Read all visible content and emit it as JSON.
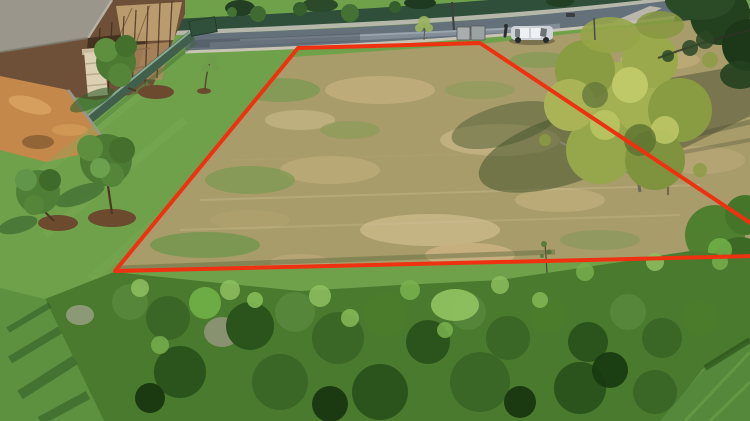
{
  "image": {
    "kind": "aerial-drone-photo",
    "subject": "vacant grass plot marked with a red boundary outline beside a street",
    "width": 750,
    "height": 421
  },
  "boundary": {
    "name": "plot-boundary",
    "color": "#ee3211",
    "stroke_width": "4",
    "path": "M 758 256 L 115 271 L 298 48 L 480 43 L 758 228",
    "corner_points": "298,48 480,43 750,223 750,258 115,271"
  },
  "palette": {
    "lawn_green": "#6fa14b",
    "lawn_dark": "#5d9140",
    "field_dry_grass": "#a89c6a",
    "road_asphalt": "#64707a",
    "curb_concrete": "#c8c4b4",
    "sidewalk_grey": "#b5b7ab",
    "fence_hedge_dark": "#2f4f3a",
    "construction_fence_green": "#41604c",
    "building_brown": "#6d5037",
    "concrete_slab": "#9b968c",
    "sand_orange": "#c4884a",
    "mulch_brown": "#6b4a2e",
    "shrub_green": "#4a7a2e",
    "big_tree_green": "#a3b152",
    "dark_canopy": "#24411f",
    "tree_shadow": "#43552c",
    "car_silver": "#cdd2d6"
  },
  "scene_objects": {
    "road": "street with wet patches along the top",
    "parked_car": "silver SUV parked at the roadside, top right",
    "person": "person standing beside the car",
    "construction_building": "house under construction with scaffolding, top left",
    "construction_fence": "green site hoarding fence below the building",
    "sand_pile": "orange builders sand at the left edge",
    "landscaped_lawn": "mowed lawn with young trees in mulch rings, left side",
    "vacant_plot": "dry patchy grass plot inside the red outline, centre",
    "big_tree": "large yellow-green tree on the right side of the plot",
    "overhanging_canopy": "dark tree canopy in the top right corner",
    "shrub_band": "dense wild shrubs across the bottom",
    "utility_boxes": "two grey utility boxes at the kerb",
    "street_pole": "pole beside the utility boxes"
  }
}
